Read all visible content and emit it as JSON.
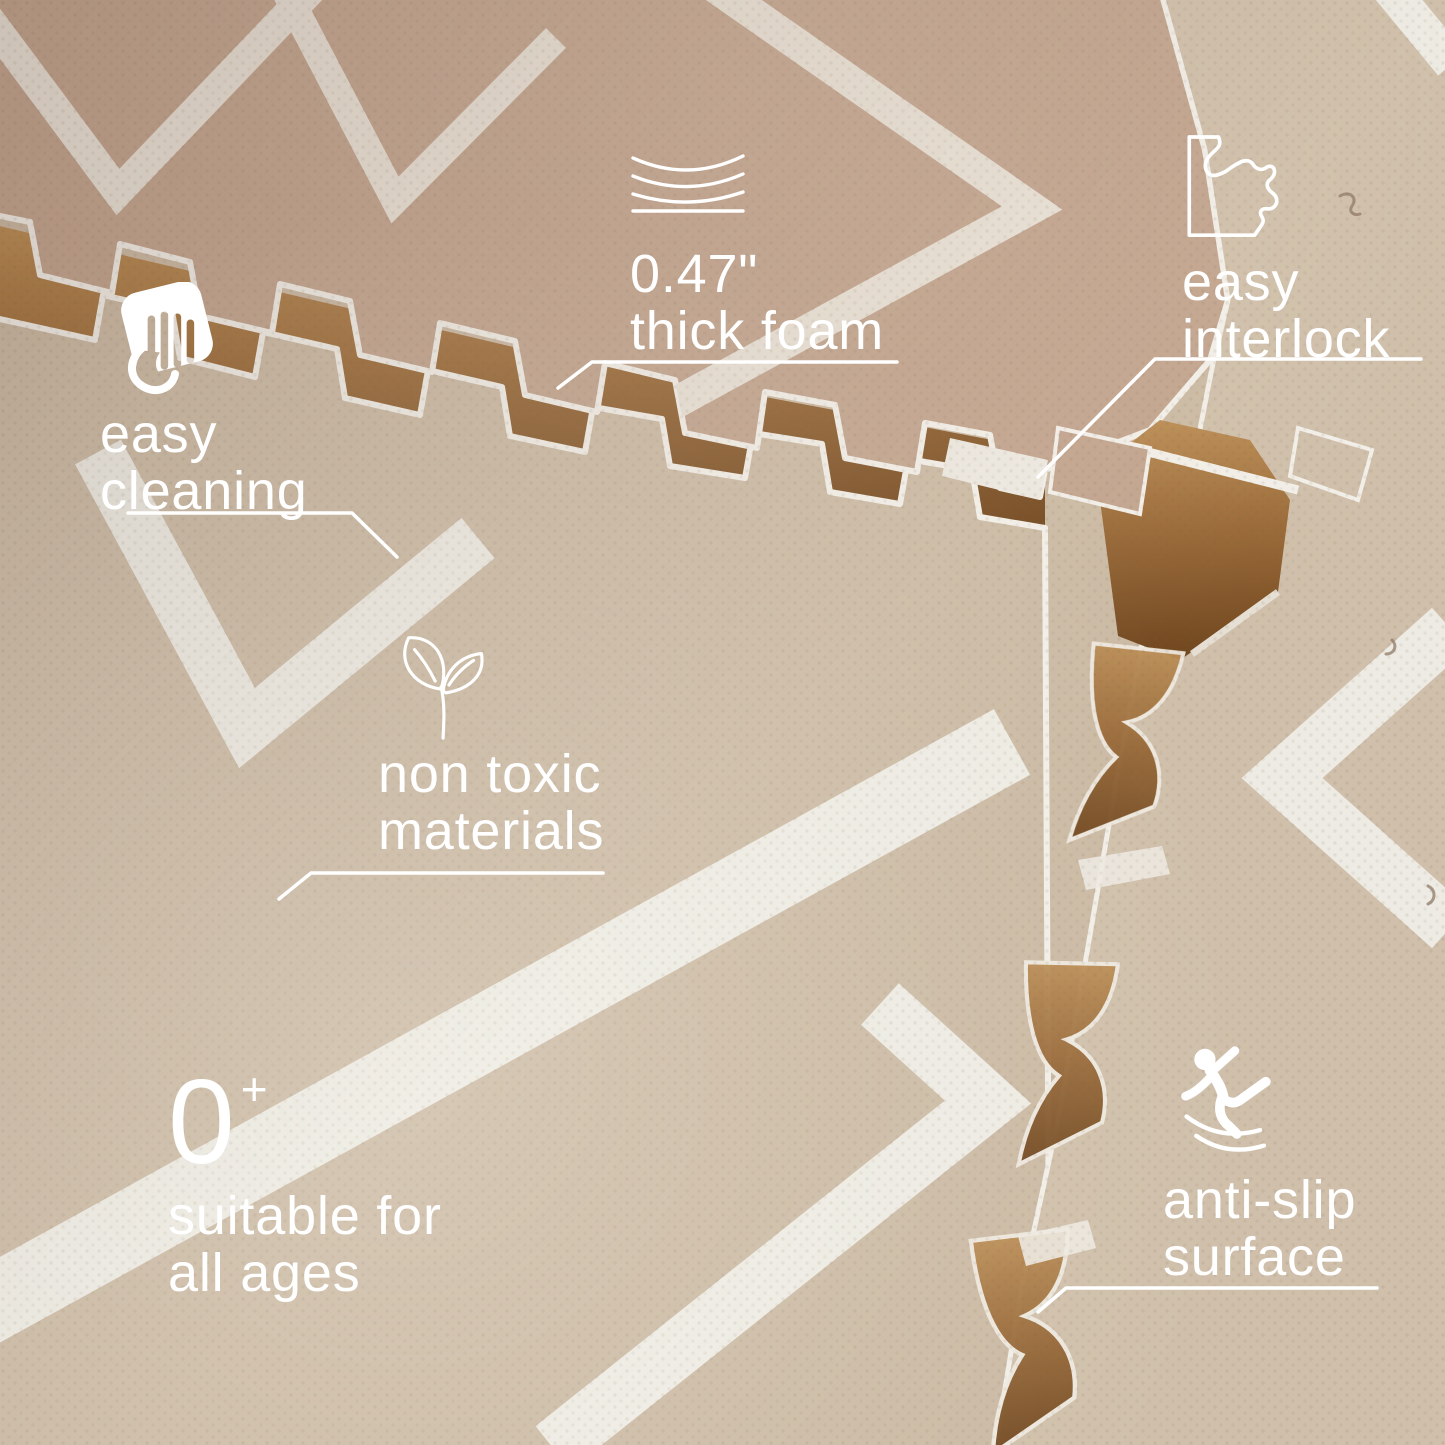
{
  "features": [
    {
      "id": "thick-foam",
      "icon": "foam-thickness-icon",
      "line1": "0.47\"",
      "line2": "thick foam"
    },
    {
      "id": "easy-interlock",
      "icon": "puzzle-interlock-icon",
      "line1": "easy",
      "line2": "interlock"
    },
    {
      "id": "easy-cleaning",
      "icon": "wiping-hand-icon",
      "line1": "easy",
      "line2": "cleaning"
    },
    {
      "id": "non-toxic",
      "icon": "sprout-leaves-icon",
      "line1": "non toxic",
      "line2": "materials"
    },
    {
      "id": "all-ages",
      "icon": "zero-plus-mark",
      "age_number": "0",
      "age_plus": "+",
      "line1": "suitable for",
      "line2": "all ages"
    },
    {
      "id": "anti-slip",
      "icon": "slipping-person-icon",
      "line1": "anti-slip",
      "line2": "surface"
    }
  ],
  "colors": {
    "label-text": "#ffffff",
    "callout-line": "#ffffff",
    "mat-upper": "#c2a58f",
    "mat-lower": "#cbbaa4",
    "mat-right": "#d0c0ab",
    "stripe-upper": "#e9e2d7",
    "stripe-lower": "#edebe3",
    "wood-floor": "#9a6a38"
  }
}
